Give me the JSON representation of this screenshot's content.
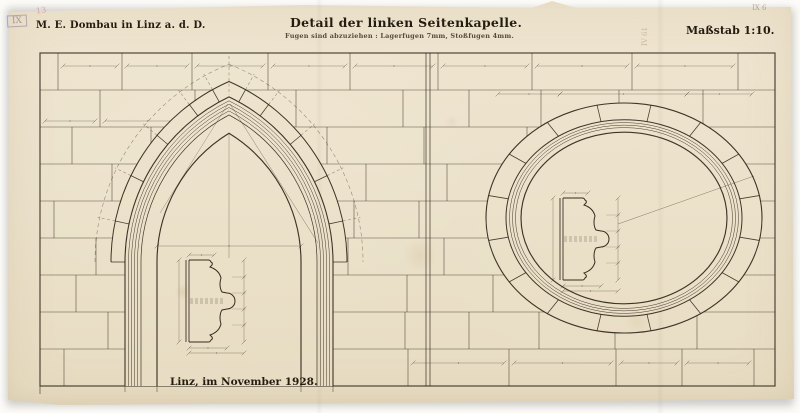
{
  "header": {
    "project_label": "M. E. Dombau in Linz a. d. D.",
    "title": "Detail der linken Seitenkapelle.",
    "subtitle": "Fugen sind abzuziehen : Lagerfugen 7mm, Stoßfugen 4mm.",
    "scale_label": "Maßstab 1:10."
  },
  "footer": {
    "date_label": "Linz, im November 1928."
  },
  "marks": {
    "stamp_top_left": "IX",
    "pencil_top_left": "13",
    "pencil_top_right": "IX 6",
    "pencil_side": "IV 61"
  },
  "colors": {
    "paper": "#ece2cb",
    "paper_top": "#efe5d0",
    "paper_bottom": "#e7dcc2",
    "ink": "#2b2115",
    "ink_light": "#4a3e2d",
    "pencil": "#9b8e76"
  }
}
